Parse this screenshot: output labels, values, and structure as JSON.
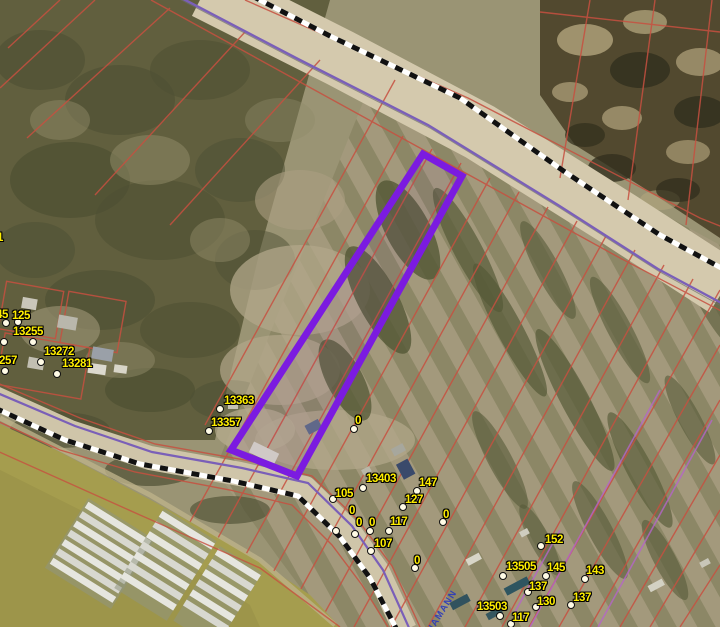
{
  "map": {
    "type": "aerial-parcel-map",
    "highlighted_parcel": {
      "outline_color": "#7b1be0",
      "shape": "long narrow strip parcel, center of map"
    },
    "colors": {
      "parcel_line_red": "#c75040",
      "parcel_highlight_purple": "#7b1be0",
      "road_centerline_purple": "#7a5fb8",
      "road_casing_checker_black": "#111111",
      "road_casing_checker_white": "#ffffff",
      "label_yellow": "#ffee00",
      "street_label_blue": "#2f3db8",
      "water_khaki": "#a59d4e",
      "plat_line_magenta": "#b565c9"
    }
  },
  "markers": [
    {
      "t": "1",
      "lx": -3,
      "ly": 233,
      "d": null
    },
    {
      "t": "45",
      "lx": -4,
      "ly": 310,
      "d": [
        6,
        323
      ]
    },
    {
      "t": "125",
      "lx": 12,
      "ly": 311,
      "d": [
        18,
        322
      ]
    },
    {
      "t": "3",
      "lx": -7,
      "ly": 327,
      "d": [
        4,
        342
      ]
    },
    {
      "t": "13255",
      "lx": 13,
      "ly": 327,
      "d": [
        33,
        342
      ]
    },
    {
      "t": "3257",
      "lx": -7,
      "ly": 356,
      "d": [
        5,
        371
      ]
    },
    {
      "t": "13272",
      "lx": 44,
      "ly": 347,
      "d": [
        41,
        362
      ]
    },
    {
      "t": "13281",
      "lx": 62,
      "ly": 359,
      "d": [
        57,
        374
      ]
    },
    {
      "t": "13363",
      "lx": 224,
      "ly": 396,
      "d": [
        220,
        409
      ]
    },
    {
      "t": "13357",
      "lx": 211,
      "ly": 418,
      "d": [
        209,
        431
      ]
    },
    {
      "t": "0",
      "lx": 355,
      "ly": 416,
      "d": [
        354,
        429
      ]
    },
    {
      "t": "13403",
      "lx": 366,
      "ly": 474,
      "d": [
        363,
        488
      ]
    },
    {
      "t": "147",
      "lx": 419,
      "ly": 478,
      "d": [
        417,
        491
      ]
    },
    {
      "t": "105",
      "lx": 335,
      "ly": 489,
      "d": [
        333,
        499
      ]
    },
    {
      "t": "127",
      "lx": 405,
      "ly": 495,
      "d": [
        403,
        507
      ]
    },
    {
      "t": "0",
      "lx": 349,
      "ly": 506,
      "d": [
        336,
        531
      ]
    },
    {
      "t": "0",
      "lx": 356,
      "ly": 518,
      "d": [
        355,
        534
      ]
    },
    {
      "t": "0",
      "lx": 369,
      "ly": 518,
      "d": [
        370,
        531
      ]
    },
    {
      "t": "117",
      "lx": 390,
      "ly": 517,
      "d": [
        389,
        531
      ]
    },
    {
      "t": "107",
      "lx": 374,
      "ly": 539,
      "d": [
        371,
        551
      ]
    },
    {
      "t": "0",
      "lx": 443,
      "ly": 510,
      "d": [
        443,
        522
      ]
    },
    {
      "t": "0",
      "lx": 414,
      "ly": 556,
      "d": [
        415,
        568
      ]
    },
    {
      "t": "152",
      "lx": 545,
      "ly": 535,
      "d": [
        541,
        546
      ]
    },
    {
      "t": "13505",
      "lx": 506,
      "ly": 562,
      "d": [
        503,
        576
      ]
    },
    {
      "t": "145",
      "lx": 547,
      "ly": 563,
      "d": [
        546,
        576
      ]
    },
    {
      "t": "143",
      "lx": 586,
      "ly": 566,
      "d": [
        585,
        579
      ]
    },
    {
      "t": "137",
      "lx": 529,
      "ly": 582,
      "d": [
        528,
        592
      ]
    },
    {
      "t": "130",
      "lx": 537,
      "ly": 597,
      "d": [
        536,
        607
      ]
    },
    {
      "t": "137",
      "lx": 573,
      "ly": 593,
      "d": [
        571,
        605
      ]
    },
    {
      "t": "13503",
      "lx": 477,
      "ly": 602,
      "d": [
        500,
        616
      ]
    },
    {
      "t": "117",
      "lx": 512,
      "ly": 613,
      "d": [
        511,
        624
      ]
    }
  ],
  "street_labels": [
    {
      "text": "HAMANN",
      "x": 434,
      "y": 624,
      "rot": -58
    }
  ]
}
